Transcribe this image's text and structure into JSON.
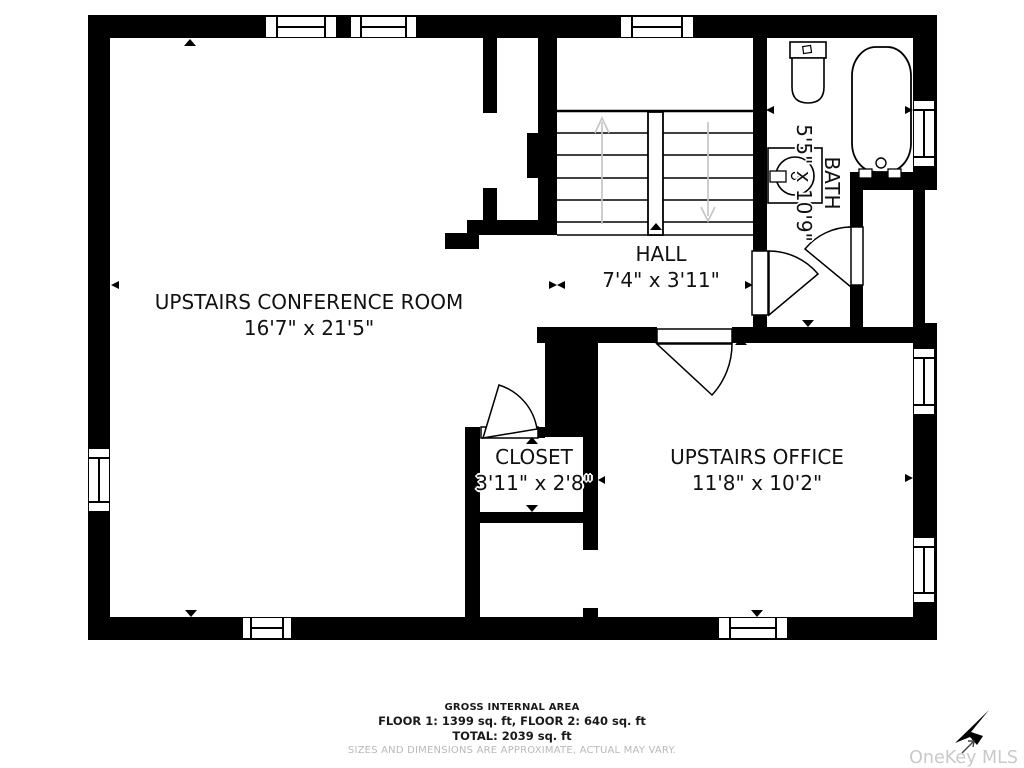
{
  "rooms": {
    "conference": {
      "name": "UPSTAIRS CONFERENCE ROOM",
      "dims": "16'7\" x 21'5\""
    },
    "hall": {
      "name": "HALL",
      "dims": "7'4\" x 3'11\""
    },
    "bath": {
      "name": "BATH",
      "dims": "5'5\" x 10'9\""
    },
    "closet": {
      "name": "CLOSET",
      "dims": "3'11\" x 2'8\""
    },
    "office": {
      "name": "UPSTAIRS OFFICE",
      "dims": "11'8\" x 10'2\""
    }
  },
  "footer": {
    "title": "GROSS INTERNAL AREA",
    "floors": "FLOOR 1: 1399 sq. ft, FLOOR 2: 640 sq. ft",
    "total": "TOTAL: 2039 sq. ft",
    "disclaimer": "SIZES AND DIMENSIONS ARE APPROXIMATE, ACTUAL MAY VARY."
  },
  "watermark": {
    "text": "OneKey MLS"
  },
  "icons": [
    "toilet-icon",
    "sink-icon",
    "bathtub-icon",
    "stairs-up-arrow-icon",
    "stairs-down-arrow-icon",
    "door-swing-icon",
    "window-icon",
    "onekey-cursor-icon"
  ],
  "colors": {
    "walls": "#000000",
    "background": "#ffffff",
    "stair_arrows": "#c6c6c6",
    "label_text": "#111111",
    "disclaimer_text": "#b9b9b9",
    "watermark_text": "#c9c9c9"
  }
}
